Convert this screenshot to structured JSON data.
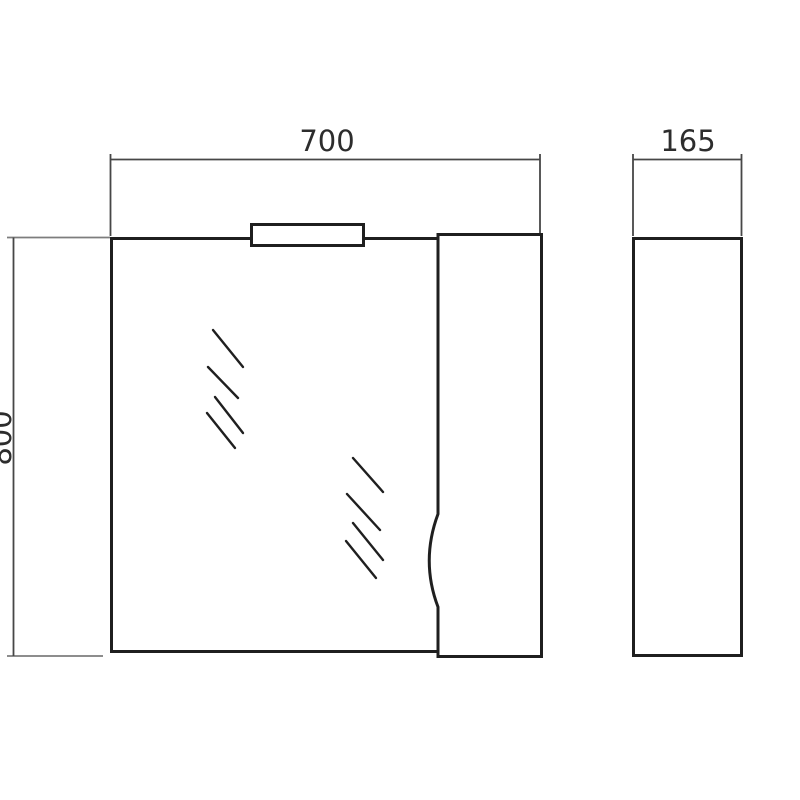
{
  "drawing": {
    "views": {
      "front": {
        "width_dimension": {
          "label": "700"
        },
        "height_dimension": {
          "label": "800"
        }
      },
      "side": {
        "depth_dimension": {
          "label": "165"
        }
      }
    },
    "colors": {
      "background": "#ffffff",
      "object_line": "#1f1f1f",
      "dimension_line": "#474747",
      "extension_line": "#7d7d7d",
      "label_text": "#2d2d2d"
    }
  }
}
